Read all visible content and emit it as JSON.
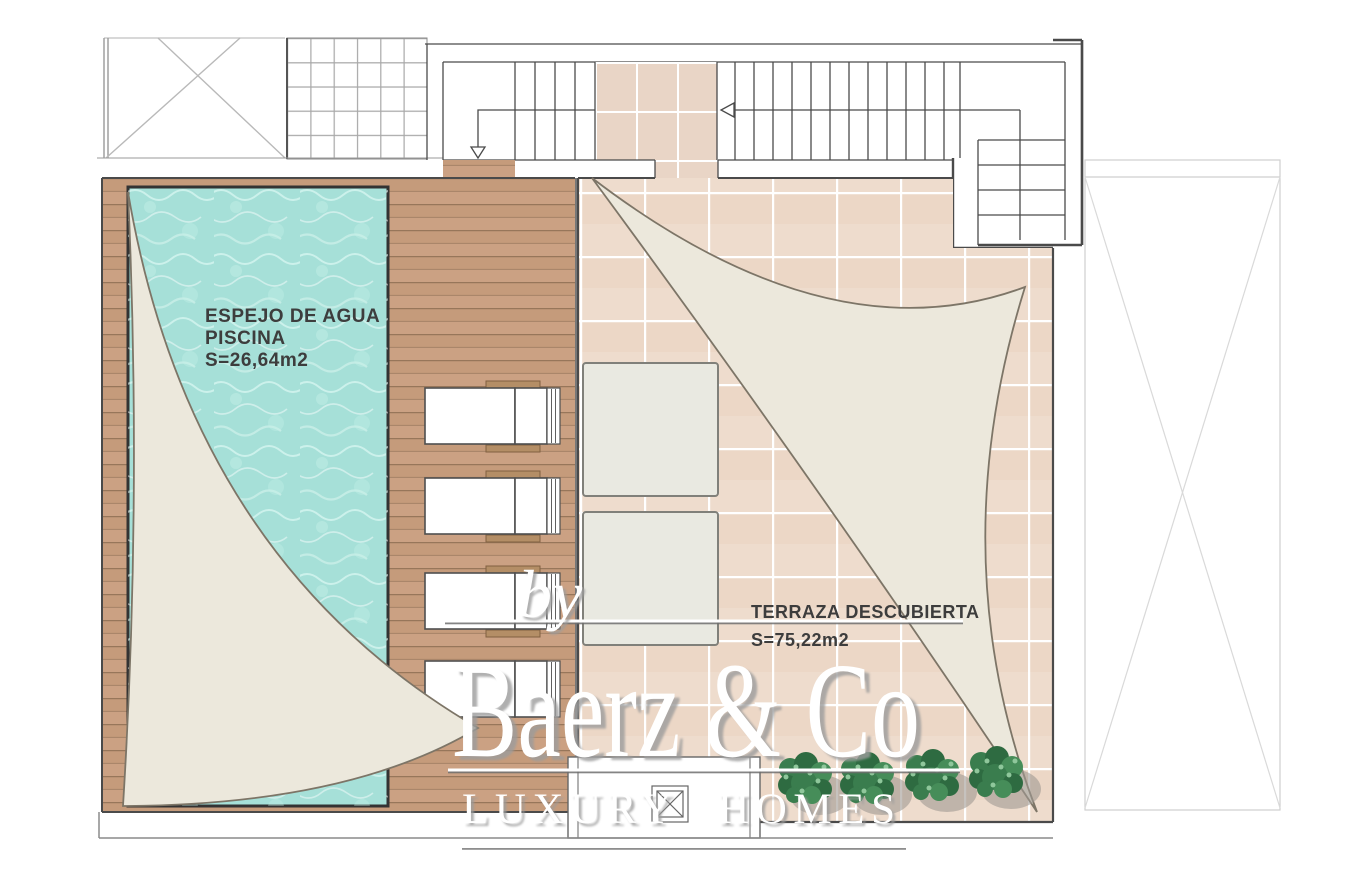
{
  "plan": {
    "pool_label": {
      "line1": "ESPEJO DE AGUA",
      "line2": "PISCINA",
      "area": "S=26,64m2"
    },
    "terrace_label": {
      "title": "TERRAZA DESCUBIERTA",
      "area": "S=75,22m2"
    }
  },
  "watermark": {
    "prefix": "by",
    "brand": "Baerz & Co",
    "tagline": "LUXURY HOMES"
  },
  "colors": {
    "water": "#a6e0d8",
    "wood": "#cba183",
    "woodline": "#97765a",
    "tile": "#eedccd",
    "tilesmall": "#e9d5c6",
    "sail": "#ece8dc",
    "sailedge": "#7d7567",
    "line": "#4a4a4a",
    "foliagedark": "#2e6b41",
    "foliagemid": "#3a7d4e",
    "foliagelight": "#468d59",
    "bushshadow": "#a09a93"
  }
}
